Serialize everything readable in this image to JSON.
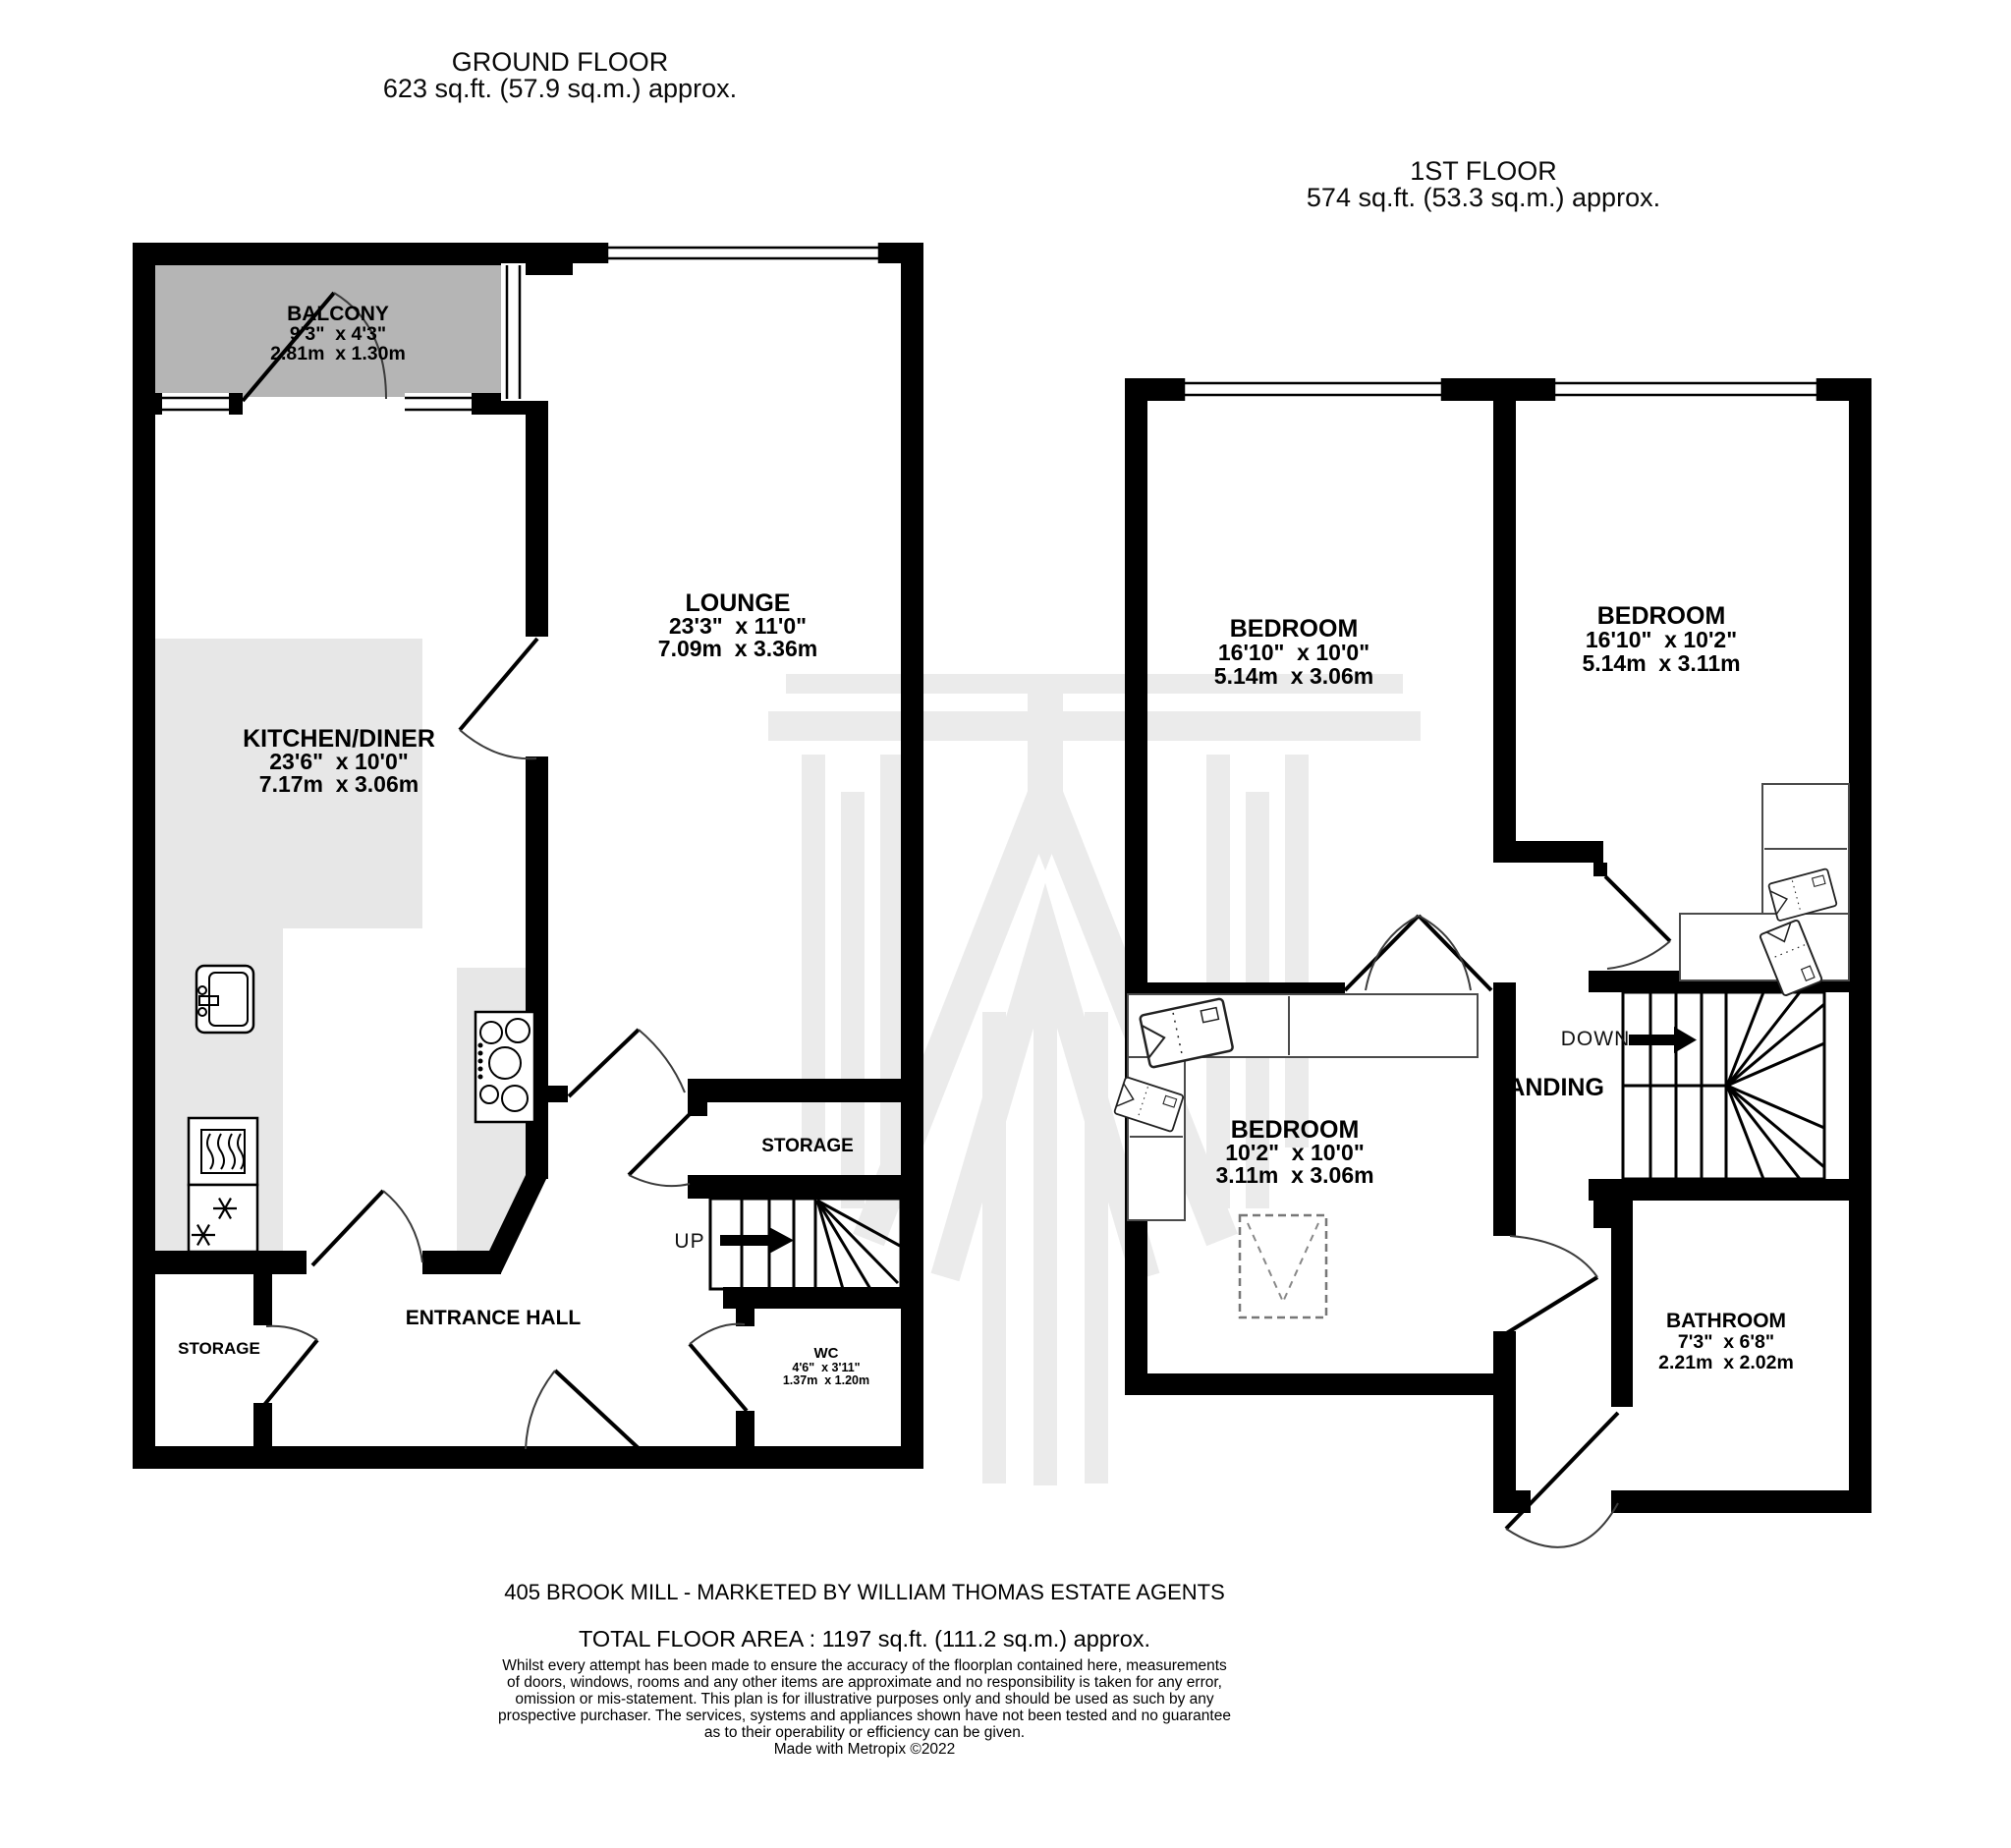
{
  "ground_floor": {
    "title": "GROUND FLOOR",
    "area": "623 sq.ft. (57.9 sq.m.) approx.",
    "stairs_label": "UP",
    "rooms": {
      "balcony": {
        "name": "BALCONY",
        "imperial": "9'3\"  x 4'3\"",
        "metric": "2.81m  x 1.30m"
      },
      "lounge": {
        "name": "LOUNGE",
        "imperial": "23'3\"  x 11'0\"",
        "metric": "7.09m  x 3.36m"
      },
      "kitchen": {
        "name": "KITCHEN/DINER",
        "imperial": "23'6\"  x 10'0\"",
        "metric": "7.17m  x 3.06m"
      },
      "entrance_hall": {
        "name": "ENTRANCE HALL"
      },
      "storage_hall": {
        "name": "STORAGE"
      },
      "storage_understairs": {
        "name": "STORAGE"
      },
      "wc": {
        "name": "WC",
        "imperial": "4'6\"  x 3'11\"",
        "metric": "1.37m  x 1.20m"
      }
    }
  },
  "first_floor": {
    "title": "1ST FLOOR",
    "area": "574 sq.ft. (53.3 sq.m.) approx.",
    "stairs_label": "DOWN",
    "rooms": {
      "bedroom1": {
        "name": "BEDROOM",
        "imperial": "16'10\"  x 10'0\"",
        "metric": "5.14m  x 3.06m"
      },
      "bedroom2": {
        "name": "BEDROOM",
        "imperial": "16'10\"  x 10'2\"",
        "metric": "5.14m  x 3.11m"
      },
      "bedroom3": {
        "name": "BEDROOM",
        "imperial": "10'2\"  x 10'0\"",
        "metric": "3.11m  x 3.06m"
      },
      "landing": {
        "name": "LANDING"
      },
      "bathroom": {
        "name": "BATHROOM",
        "imperial": "7'3\"  x 6'8\"",
        "metric": "2.21m  x 2.02m"
      }
    }
  },
  "footer": {
    "marketing_line": "405 BROOK MILL - MARKETED BY WILLIAM THOMAS ESTATE AGENTS",
    "total_area": "TOTAL FLOOR AREA : 1197 sq.ft. (111.2 sq.m.) approx.",
    "disclaimer_lines": [
      "Whilst every attempt has been made to ensure the accuracy of the floorplan contained here, measurements",
      "of doors, windows, rooms and any other items are approximate and no responsibility is taken for any error,",
      "omission or mis-statement. This plan is for illustrative purposes only and should be used as such by any",
      "prospective purchaser. The services, systems and appliances shown have not been tested and no guarantee",
      "as to their operability or efficiency can be given."
    ],
    "credit": "Made with Metropix ©2022"
  },
  "colors": {
    "wall": "#000000",
    "balcony_fill": "#b5b5b5",
    "counter_fill": "#e7e7e7",
    "watermark": "#ebebeb"
  }
}
